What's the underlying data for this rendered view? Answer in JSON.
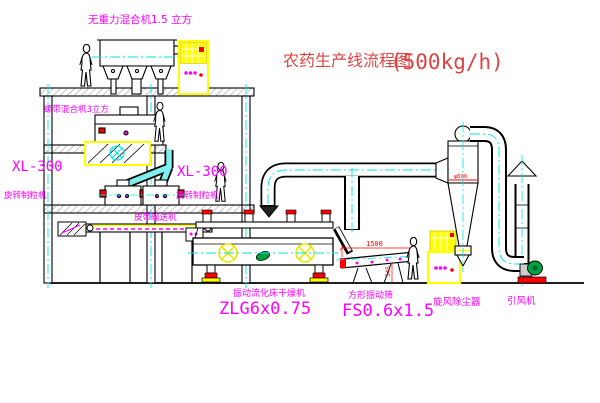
{
  "title": {
    "name_cn": "农药生产线流程图",
    "capacity": "(500kg/h)"
  },
  "labels": {
    "top_mixer": "无重力混合机1.5 立方",
    "ribbon_mixer": "螺带混合机3立方",
    "granulator_left_model": "XL-300",
    "granulator_left_name": "旋转制粒机",
    "granulator_mid_model": "XL-300",
    "granulator_mid_name": "旋转制粒机",
    "belt_conveyor": "皮带输送机",
    "dryer_name": "振动流化床干燥机",
    "dryer_model": "ZLG6x0.75",
    "sieve_name": "方形振动筛",
    "sieve_model": "FS0.6x1.5",
    "cyclone_name": "旋风除尘器",
    "fan_name": "引风机"
  },
  "dimensions": {
    "sieve_length": "1500",
    "sieve_height": "545",
    "cyclone_diameter": "φ600"
  },
  "colors": {
    "label_magenta": "#ff00ff",
    "title_red": "#dd4444",
    "dimension_red": "#ff0000",
    "centerline_cyan": "#00e5e5",
    "cabinet_yellow": "#ffff00",
    "motor_green": "#00a040",
    "line_black": "#000000"
  }
}
